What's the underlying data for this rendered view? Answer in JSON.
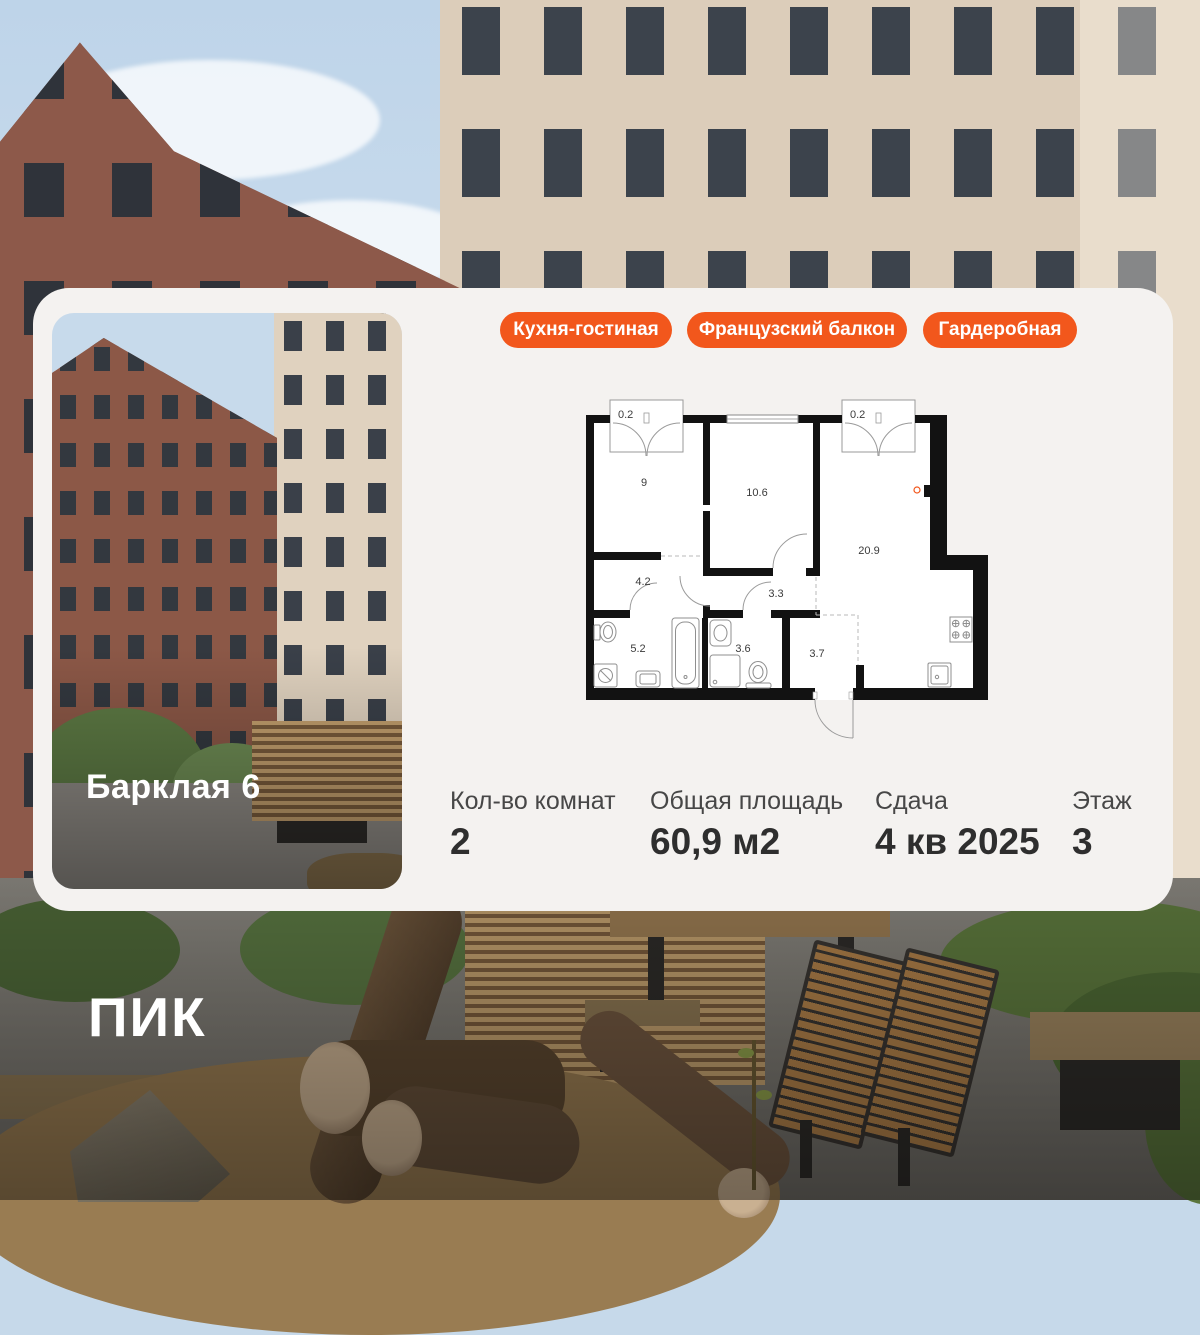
{
  "brand": {
    "logo": "ПИК"
  },
  "colors": {
    "accent": "#F2571C",
    "card_bg": "#F4F2F0",
    "wall": "#121212"
  },
  "card": {
    "photo_label": "Барклая 6",
    "badges": [
      "Кухня-гостиная",
      "Французский балкон",
      "Гардеробная"
    ],
    "stats": [
      {
        "label": "Кол-во комнат",
        "value": "2"
      },
      {
        "label": "Общая площадь",
        "value": "60,9 м2"
      },
      {
        "label": "Сдача",
        "value": "4 кв 2025"
      },
      {
        "label": "Этаж",
        "value": "3"
      }
    ],
    "floorplan": {
      "rooms": [
        {
          "name": "balcony-left",
          "area": "0.2"
        },
        {
          "name": "bedroom",
          "area": "9"
        },
        {
          "name": "room",
          "area": "10.6"
        },
        {
          "name": "balcony-right",
          "area": "0.2"
        },
        {
          "name": "kitchen-living",
          "area": "20.9"
        },
        {
          "name": "hall",
          "area": "4.2"
        },
        {
          "name": "corridor",
          "area": "3.3"
        },
        {
          "name": "bathroom",
          "area": "5.2"
        },
        {
          "name": "shower-room",
          "area": "3.6"
        },
        {
          "name": "wardrobe-hall",
          "area": "3.7"
        }
      ]
    }
  }
}
